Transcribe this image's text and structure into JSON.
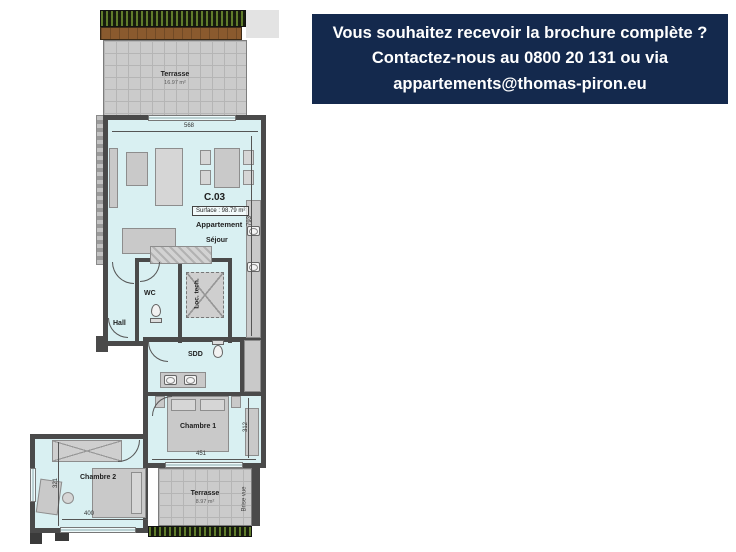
{
  "banner": {
    "line1": "Vous souhaitez recevoir la brochure complète ?",
    "line2": "Contactez-nous au 0800 20 131 ou via",
    "line3": "appartements@thomas-piron.eu",
    "bg_color": "#14294d",
    "text_color": "#ffffff"
  },
  "plan": {
    "unit_id": "C.03",
    "surface": "Surface : 98.79 m²",
    "unit_type": "Appartement",
    "terrace_top": {
      "name": "Terrasse",
      "area": "16.97 m²"
    },
    "terrace_bottom": {
      "name": "Terrasse",
      "area": "8.97 m²"
    },
    "rooms": {
      "sejour": "Séjour",
      "wc": "WC",
      "hall": "Hall",
      "loc_tech": "Loc. tech.",
      "sdd": "SDD",
      "chambre1": "Chambre 1",
      "chambre2": "Chambre 2"
    },
    "dims": {
      "top": "568",
      "right": "793",
      "c1_width": "451",
      "c1_depth": "312",
      "c2_depth": "321",
      "c2_width": "400"
    },
    "brise_vue": "Brise vue",
    "colors": {
      "interior": "#d9f0f2",
      "walls": "#4a4a4a",
      "terrace": "#cbcbcb",
      "hedge": "#20241a",
      "deck": "#8a5a2e"
    }
  }
}
